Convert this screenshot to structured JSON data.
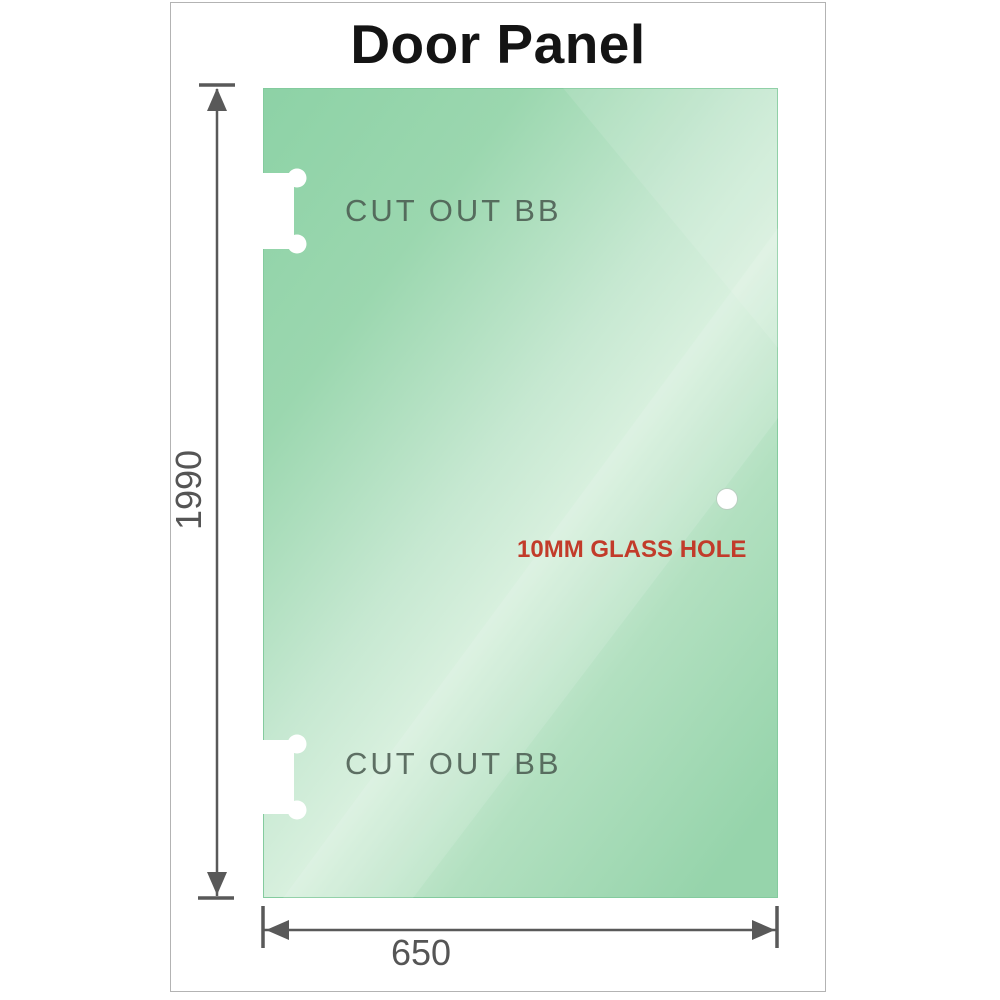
{
  "title": "Door Panel",
  "panel": {
    "description": "glass door panel drawing",
    "glass_gradient": {
      "dark": "#8dd2a6",
      "mid": "#9bd7af",
      "streak_light": "#d8f0de",
      "mid2": "#b2e0c0",
      "end": "#96d4ab",
      "edge_stroke": "#84cb9e"
    },
    "cutouts": [
      {
        "label": "CUT OUT BB",
        "position": "top-left edge"
      },
      {
        "label": "CUT OUT BB",
        "position": "bottom-left edge"
      }
    ],
    "hole": {
      "label": "10MM GLASS HOLE",
      "label_color": "#c23b2a",
      "position": "right side"
    }
  },
  "dimensions": {
    "height": {
      "value": "1990"
    },
    "width": {
      "value": "650"
    },
    "line_color": "#595959",
    "label_color": "#555555"
  }
}
